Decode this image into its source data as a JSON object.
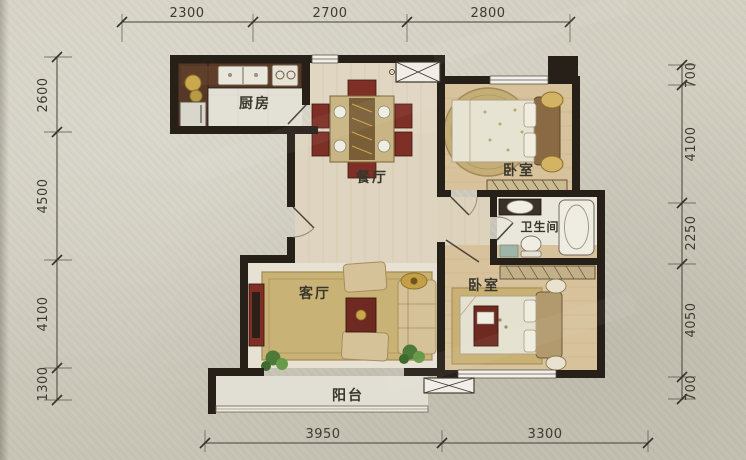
{
  "floor_plan": {
    "rooms": {
      "kitchen": {
        "label": "厨房"
      },
      "dining": {
        "label": "餐厅"
      },
      "bedroom_top": {
        "label": "卧室"
      },
      "bathroom": {
        "label": "卫生间"
      },
      "living": {
        "label": "客厅"
      },
      "bedroom_bottom": {
        "label": "卧室"
      },
      "balcony": {
        "label": "阳台"
      }
    },
    "dimensions_mm": {
      "top": [
        "2300",
        "2700",
        "2800"
      ],
      "bottom": [
        "3950",
        "3300"
      ],
      "left": [
        "2600",
        "4500",
        "4100",
        "1300"
      ],
      "right": [
        "700",
        "4100",
        "2250",
        "4050",
        "700"
      ]
    },
    "colors": {
      "paper": "#cfccbe",
      "wall": "#262019",
      "wood_floor": "#d8c29c",
      "hall_floor": "#e0d6c2",
      "rug_gold": "#c8b070",
      "furniture_maroon": "#7e2f26",
      "sofa_tan": "#d6c298",
      "fixture_white": "#eeebe0",
      "dimension_text": "#3d3b31"
    }
  }
}
